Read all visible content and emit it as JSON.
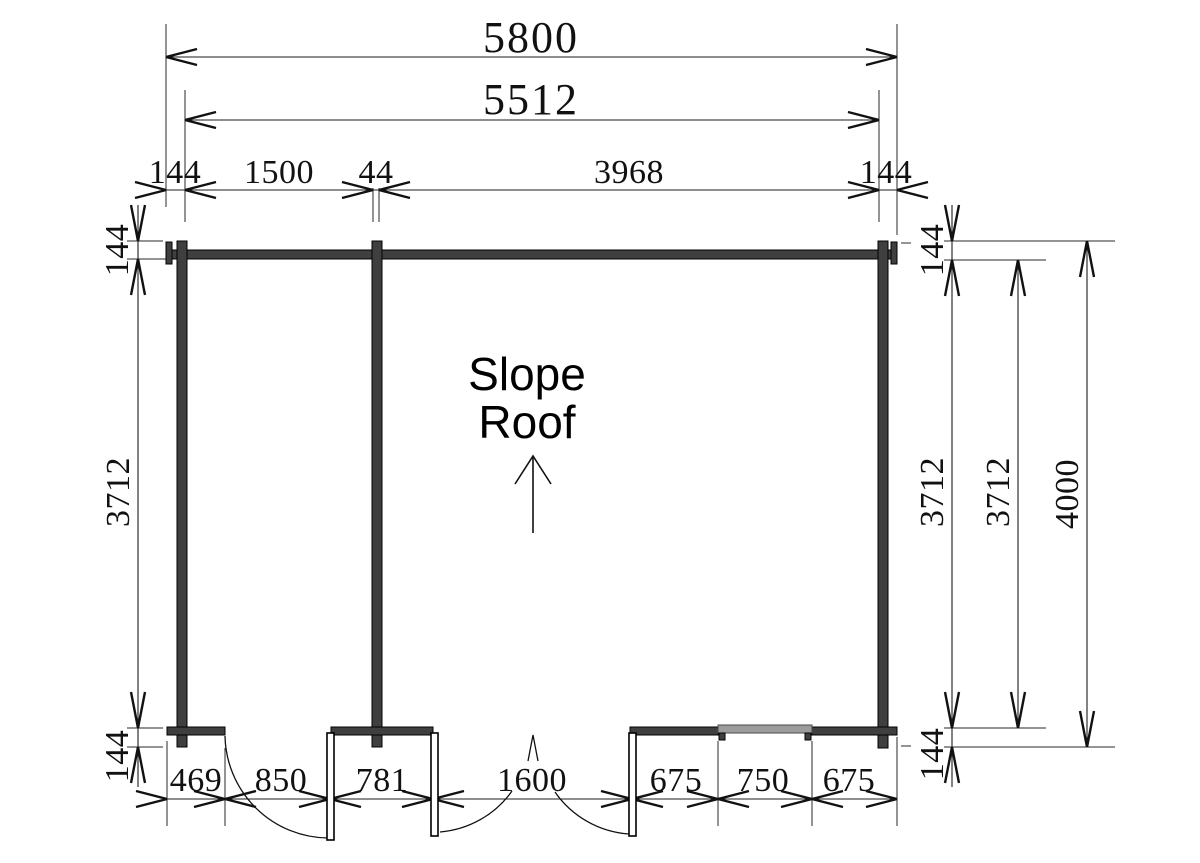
{
  "drawing": {
    "roof_label_line1": "Slope",
    "roof_label_line2": "Roof"
  },
  "colors": {
    "wall": "#3f3f3f",
    "window": "#9c9c9c",
    "line": "#1c1c1c",
    "background": "#ffffff"
  },
  "dimensions": {
    "overall_width": "5800",
    "log_length": "5512",
    "top_segments": [
      "144",
      "1500",
      "44",
      "3968",
      "144"
    ],
    "left_column": {
      "top": "144",
      "middle": "3712",
      "bottom": "144"
    },
    "right_column": {
      "top": "144",
      "inner": "3712",
      "inner2": "3712",
      "outer": "4000",
      "bottom": "144"
    },
    "bottom_segments": [
      "469",
      "850",
      "781",
      "1600",
      "675",
      "750",
      "675"
    ]
  }
}
